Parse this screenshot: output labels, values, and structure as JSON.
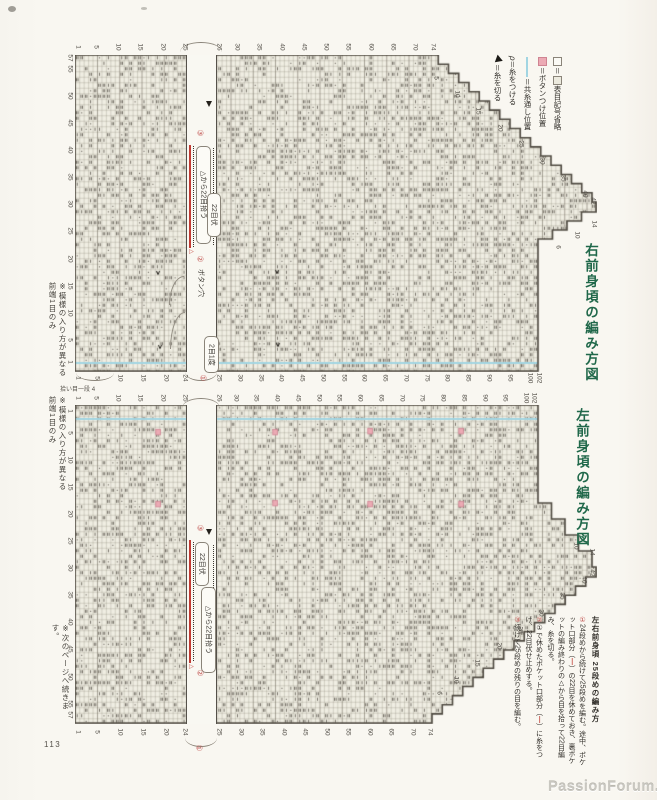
{
  "page": {
    "number": "113",
    "watermark": "PassionForum.ru",
    "notes": {
      "pattern_note_lines": [
        "※模様の入り方が異なる",
        "前端1目のみ"
      ],
      "next_page": "※次のページへ続きます。",
      "pickup_note": "拾い目一段",
      "pickup_count": "4"
    }
  },
  "legend": {
    "items": [
      {
        "icon": "blank-square",
        "eq": "＝",
        "icon2": "marked-square",
        "label": "表目記号省略"
      },
      {
        "icon": "pink-square",
        "label": "＝ボタンつけ位置"
      },
      {
        "icon": "blue-line",
        "label": "＝共糸通し位置"
      },
      {
        "icon": "attach-yarn",
        "glyph": "ρ",
        "label": "＝糸をつける"
      },
      {
        "icon": "cut-yarn",
        "label": "＝糸を切る"
      }
    ]
  },
  "charts": [
    {
      "id": "right_front",
      "title": "右前身頃の編み方図",
      "stitches": 57,
      "rows_lower": 102,
      "rows_upper": 74,
      "edges": {
        "outer_a": [
          1,
          5,
          10,
          15,
          20,
          25
        ],
        "outer_b": [
          26,
          30,
          35,
          40,
          45,
          50,
          55,
          60,
          65,
          70,
          74
        ],
        "inner_a": [
          1,
          5,
          10,
          15,
          20,
          24
        ],
        "inner_b": [
          25,
          30,
          35,
          40,
          45,
          50,
          55,
          60,
          65,
          70,
          75,
          80,
          85,
          90,
          95,
          100,
          102
        ],
        "side": [
          57,
          55,
          50,
          45,
          40,
          35,
          30,
          25,
          20,
          15,
          10,
          5,
          1
        ],
        "diagonal": [
          5,
          10,
          15,
          20,
          25,
          30,
          35,
          40,
          42
        ],
        "peak": [
          14,
          10,
          6
        ]
      },
      "gap": {
        "step1": "①",
        "step2": "②",
        "step3": "③",
        "pickup": "△から22目拾う",
        "bindoff": "22目伏",
        "triangle": "△",
        "buttonhole": "ボタン穴",
        "decrease": "2目1度"
      },
      "yarn_marks": [
        {
          "x": 158,
          "y": 273
        },
        {
          "x": 277,
          "y": 272
        },
        {
          "x": 160,
          "y": 347
        },
        {
          "x": 278,
          "y": 345
        }
      ]
    },
    {
      "id": "left_front",
      "title": "左前身頃の編み方図",
      "stitches": 57,
      "rows_lower": 102,
      "rows_upper": 74,
      "edges": {
        "top_a": [
          1,
          5,
          10,
          15,
          20,
          25
        ],
        "top_b": [
          26,
          30,
          35,
          40,
          45,
          50,
          55,
          60,
          65,
          70,
          75,
          80,
          85,
          90,
          95,
          100,
          102
        ],
        "bottom_a": [
          1,
          5,
          10,
          15,
          20,
          24
        ],
        "bottom_b": [
          25,
          30,
          35,
          40,
          45,
          50,
          55,
          60,
          65,
          70,
          74
        ],
        "side": [
          1,
          5,
          10,
          15,
          20,
          25,
          30,
          35,
          40,
          45,
          50,
          55,
          57
        ],
        "diagonal": [
          6,
          10,
          15,
          20,
          25,
          30,
          35,
          40,
          42
        ],
        "peak": [
          14,
          10
        ]
      },
      "gap": {
        "step1": "①",
        "step2": "②",
        "step3": "③",
        "pickup": "△から22目拾う",
        "bindoff": "22目伏",
        "triangle": "△"
      },
      "button_positions": [
        {
          "x": 158,
          "y": 432
        },
        {
          "x": 275,
          "y": 432
        },
        {
          "x": 370,
          "y": 431
        },
        {
          "x": 461,
          "y": 431
        },
        {
          "x": 158,
          "y": 504
        },
        {
          "x": 275,
          "y": 503
        },
        {
          "x": 370,
          "y": 504
        },
        {
          "x": 461,
          "y": 504
        }
      ]
    }
  ],
  "instructions": {
    "heading": "左右前身頃 25段めの編み方",
    "steps": [
      {
        "num": "①",
        "before": "24段めから続けて25段めを編む。途中、ポケット口部分（",
        "dash": "―",
        "after": "）の22目を休めておき、裏ポケットの編み終わりの△から目を拾って22目編み、糸を切る。"
      },
      {
        "num": "②",
        "before": "①で休めたポケット口部分（",
        "dash": "―",
        "after": "）に糸をつけ、22目伏せ止めする。"
      },
      {
        "num": "③",
        "before": "続けて25段めの残りの目を編む。",
        "dash": "",
        "after": ""
      }
    ]
  },
  "colors": {
    "title_green": "#20684a",
    "accent_red": "#c13b33",
    "button_pink": "#ecaab4",
    "thread_blue": "#a2d5e2",
    "paper": "#f8f6f0"
  }
}
